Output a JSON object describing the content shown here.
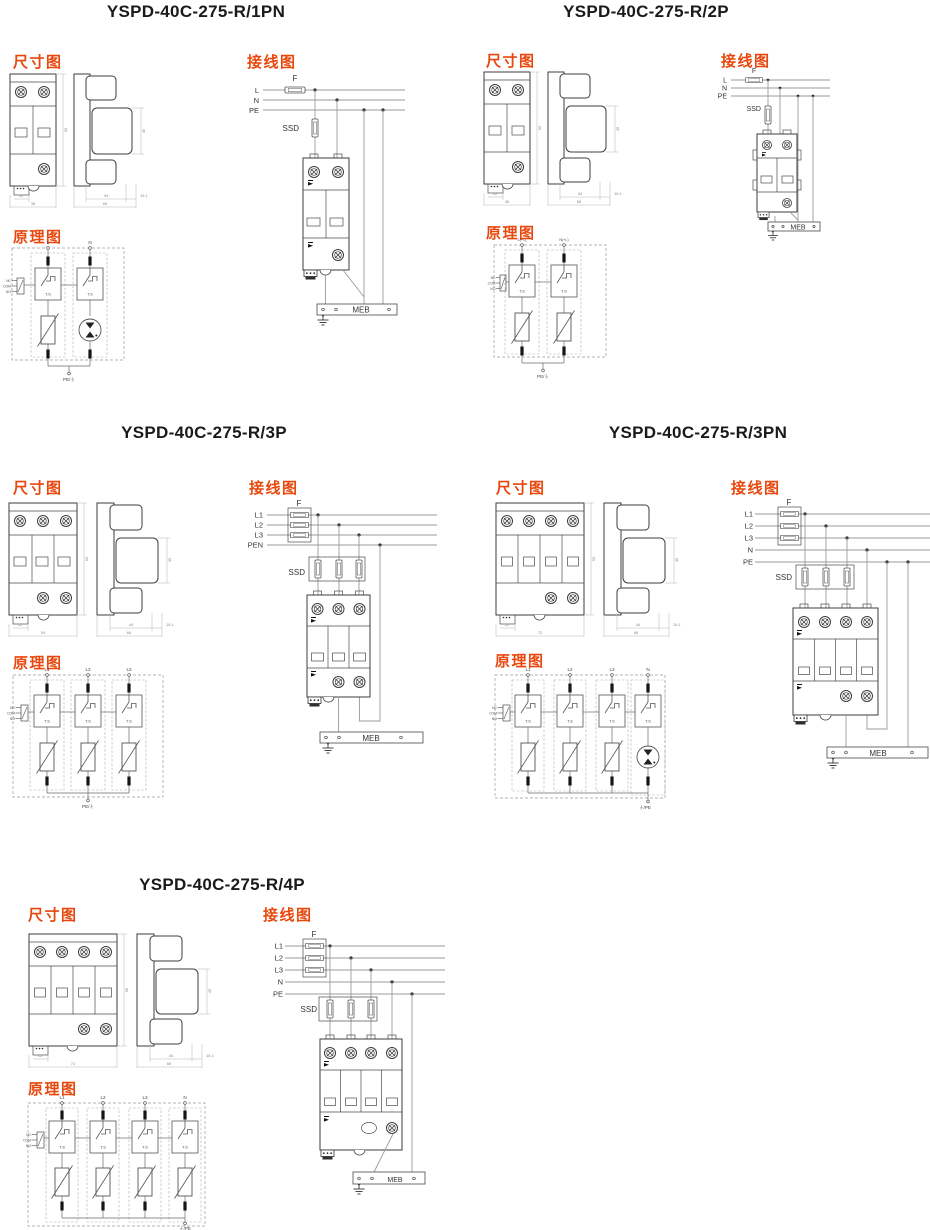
{
  "page": {
    "background": "#ffffff",
    "accent": "#e8480e",
    "ink": "#1a1a1a"
  },
  "c": {
    "dim": "尺寸图",
    "wir": "接线图",
    "sch": "原理图",
    "ts": "T.S",
    "nc": "NC",
    "com": "COM",
    "no": "NO",
    "f": "F",
    "ssd": "SSD",
    "meb": "MEB"
  },
  "s": [
    {
      "title": "YSPD-40C-275-R/1PN",
      "lines": {
        "l1": "L",
        "l2": "N",
        "l3": "PE"
      },
      "sch": {
        "t1": "L",
        "t2": "N",
        "bottom": "PE/⏚"
      },
      "dims": {
        "w": "36",
        "p": "12",
        "h": "90",
        "d": "66",
        "d1": "44",
        "d2": "16.1",
        "wh": "45"
      },
      "schematic_elements": [
        "mov",
        "gdt"
      ]
    },
    {
      "title": "YSPD-40C-275-R/2P",
      "lines": {
        "l1": "L",
        "l2": "N",
        "l3": "PE"
      },
      "sch": {
        "t1": "L(+/-)",
        "t2": "N(+/-)",
        "bottom": "PE/⏚"
      },
      "dims": {
        "w": "36",
        "p": "12",
        "h": "90",
        "d": "66",
        "d1": "44",
        "d2": "16.1",
        "wh": "45"
      },
      "schematic_elements": [
        "mov",
        "mov"
      ]
    },
    {
      "title": "YSPD-40C-275-R/3P",
      "lines": {
        "l1": "L1",
        "l2": "L2",
        "l3": "L3",
        "l4": "PEN"
      },
      "sch": {
        "t1": "L1",
        "t2": "L2",
        "t3": "L3",
        "bottom": "PE/⏚"
      },
      "dims": {
        "w": "54",
        "p": "12",
        "h": "90",
        "d": "66",
        "d1": "44",
        "d2": "16.1",
        "wh": "45"
      },
      "schematic_elements": [
        "mov",
        "mov",
        "mov"
      ]
    },
    {
      "title": "YSPD-40C-275-R/3PN",
      "lines": {
        "l1": "L1",
        "l2": "L2",
        "l3": "L3",
        "l4": "N",
        "l5": "PE"
      },
      "sch": {
        "t1": "L1",
        "t2": "L2",
        "t3": "L3",
        "t4": "N",
        "bottom": "⏚/PE"
      },
      "dims": {
        "w": "72",
        "p": "12",
        "h": "90",
        "d": "66",
        "d1": "44",
        "d2": "16.1",
        "wh": "45"
      },
      "schematic_elements": [
        "mov",
        "mov",
        "mov",
        "gdt"
      ]
    },
    {
      "title": "YSPD-40C-275-R/4P",
      "lines": {
        "l1": "L1",
        "l2": "L2",
        "l3": "L3",
        "l4": "N",
        "l5": "PE"
      },
      "sch": {
        "t1": "L1",
        "t2": "L2",
        "t3": "L3",
        "t4": "N",
        "bottom": "⏚/PE"
      },
      "dims": {
        "w": "72",
        "p": "12",
        "h": "90",
        "d": "66",
        "d1": "44",
        "d2": "16.1",
        "wh": "45"
      },
      "schematic_elements": [
        "mov",
        "mov",
        "mov",
        "mov"
      ]
    }
  ]
}
